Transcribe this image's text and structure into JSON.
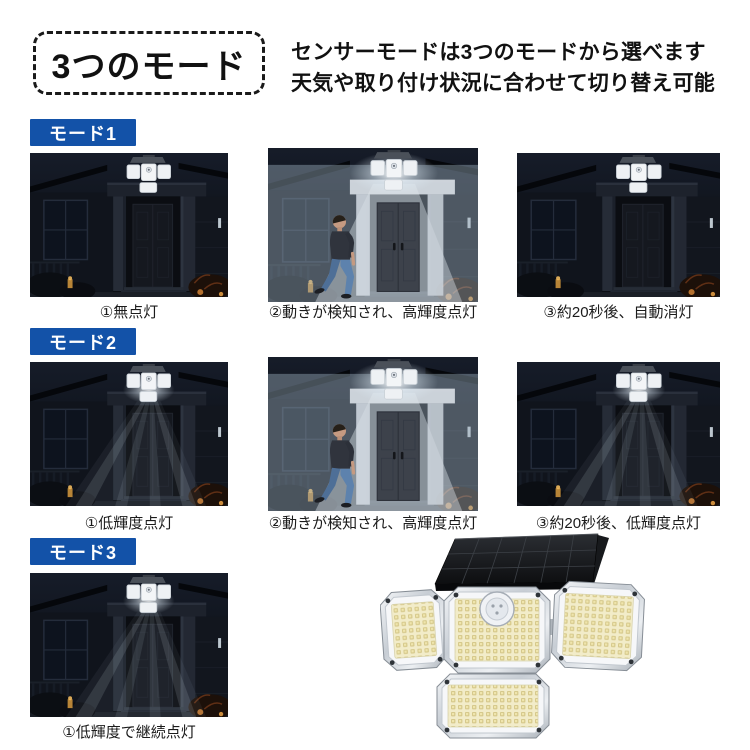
{
  "colors": {
    "accent-blue": "#1352a8",
    "badge-border": "#1a1a1a",
    "caption-text": "#1b1b1b",
    "led-warm": "#d6c98c",
    "night-sky": "#10151d"
  },
  "header": {
    "badge": "3つのモード",
    "line1": "センサーモードは3つのモードから選べます",
    "line2": "天気や取り付け状況に合わせて切り替え可能"
  },
  "modes": [
    {
      "label": "モード1",
      "photos": [
        {
          "scene": "dark",
          "caption": "①無点灯"
        },
        {
          "scene": "bright",
          "caption": "②動きが検知され、高輝度点灯"
        },
        {
          "scene": "dark",
          "caption": "③約20秒後、自動消灯"
        }
      ]
    },
    {
      "label": "モード2",
      "photos": [
        {
          "scene": "dim",
          "caption": "①低輝度点灯"
        },
        {
          "scene": "bright",
          "caption": "②動きが検知され、高輝度点灯"
        },
        {
          "scene": "dim",
          "caption": "③約20秒後、低輝度点灯"
        }
      ]
    },
    {
      "label": "モード3",
      "photos": [
        {
          "scene": "dim",
          "caption": "①低輝度で継続点灯"
        }
      ]
    }
  ]
}
